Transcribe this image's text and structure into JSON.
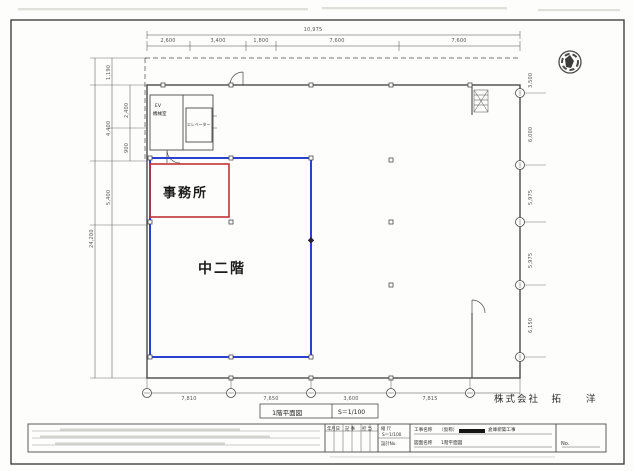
{
  "drawing": {
    "office_label": "事務所",
    "mezzanine_label": "中二階",
    "ev_line1": "EV",
    "ev_line2": "機械室",
    "elevator_label": "エレベーター"
  },
  "dimensions": {
    "top_overall": "10,975",
    "top_segments": [
      "2,600",
      "3,400",
      "1,800",
      "7,600",
      "7,600"
    ],
    "left_overall": "24,200",
    "left_segments": [
      "1,190",
      "4,400",
      "2,400",
      "900",
      "5,400"
    ],
    "right_segments": [
      "3,500",
      "6,000",
      "5,975",
      "5,975",
      "6,150"
    ],
    "bottom_segments": [
      "7,810",
      "7,650",
      "3,600",
      "7,815"
    ]
  },
  "caption": {
    "title": "1階平面図",
    "scale": "S＝1/100"
  },
  "company": "株式会社　拓　　洋",
  "titleblock": {
    "rev_headers": [
      "年月日",
      "記 事",
      "担 当"
    ],
    "scale_label": "縮 尺",
    "scale_value": "S＝1/100",
    "design_no": "設計No.",
    "project_label": "工事名称",
    "project_pre": "（仮称）",
    "project_post": "倉庫新築工事",
    "drawing_label": "図面名称",
    "drawing_value": "1階平面図",
    "no_label": "No."
  }
}
